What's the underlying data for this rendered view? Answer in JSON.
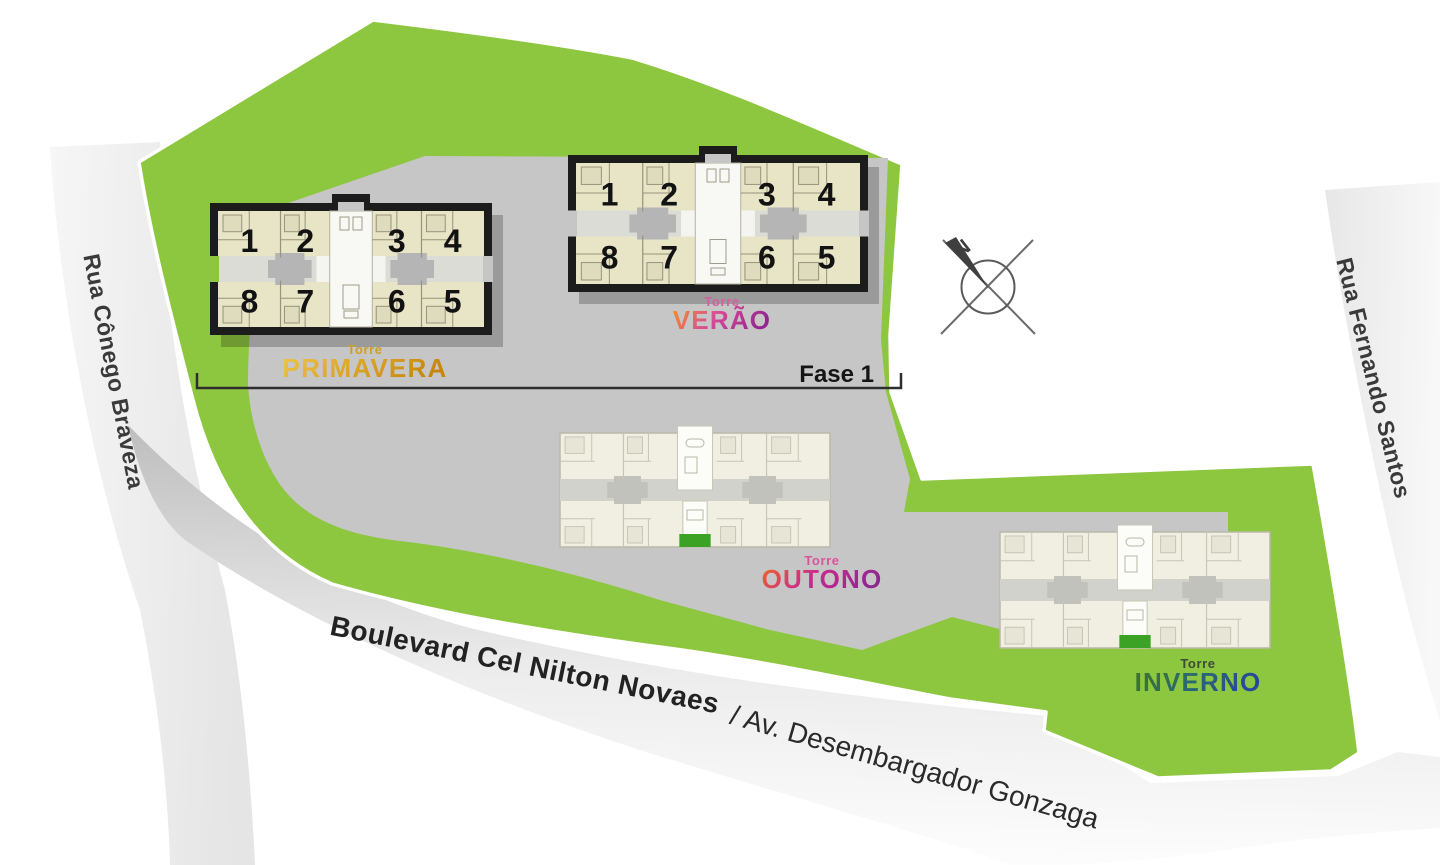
{
  "site": {
    "phase_label": "Fase 1",
    "compass_label": "N"
  },
  "streets": {
    "left": "Rua Cônego Braveza",
    "right": "Rua Fernando Santos",
    "bottom_primary": "Boulevard Cel Nilton Novaes",
    "bottom_secondary": "/ Av. Desembargador Gonzaga"
  },
  "towers": [
    {
      "id": "primavera",
      "torre_label": "Torre",
      "name": "PRIMAVERA",
      "plan_style": "outlined",
      "units_top": [
        "1",
        "2",
        "3",
        "4"
      ],
      "units_bottom": [
        "8",
        "7",
        "6",
        "5"
      ],
      "name_gradient": [
        "#f0c545",
        "#c8860d"
      ],
      "torre_color": "#cf9f25"
    },
    {
      "id": "verao",
      "torre_label": "Torre",
      "name": "VERÃO",
      "plan_style": "outlined",
      "units_top": [
        "1",
        "2",
        "3",
        "4"
      ],
      "units_bottom": [
        "8",
        "7",
        "6",
        "5"
      ],
      "name_gradient": [
        "#f7941d",
        "#d94a97",
        "#93278f"
      ],
      "torre_color": "#d4609f"
    },
    {
      "id": "outono",
      "torre_label": "Torre",
      "name": "OUTONO",
      "plan_style": "light",
      "units_top": [],
      "units_bottom": [],
      "name_gradient": [
        "#f26522",
        "#cc2a8e",
        "#8f2790"
      ],
      "torre_color": "#d8559c"
    },
    {
      "id": "inverno",
      "torre_label": "Torre",
      "name": "INVERNO",
      "plan_style": "light",
      "units_top": [],
      "units_bottom": [],
      "name_gradient": [
        "#44741f",
        "#2a6b6b",
        "#27479e"
      ],
      "torre_color": "#3d4a35"
    }
  ],
  "colors": {
    "terrain_green": "#8dc63f",
    "paved_gray": "#c6c6c6",
    "entrance_green": "#3ca226",
    "building_outline": "#1c1c1c",
    "building_fill_beige": "#e8e4c6",
    "building_fill_cream": "#f0efe2"
  }
}
